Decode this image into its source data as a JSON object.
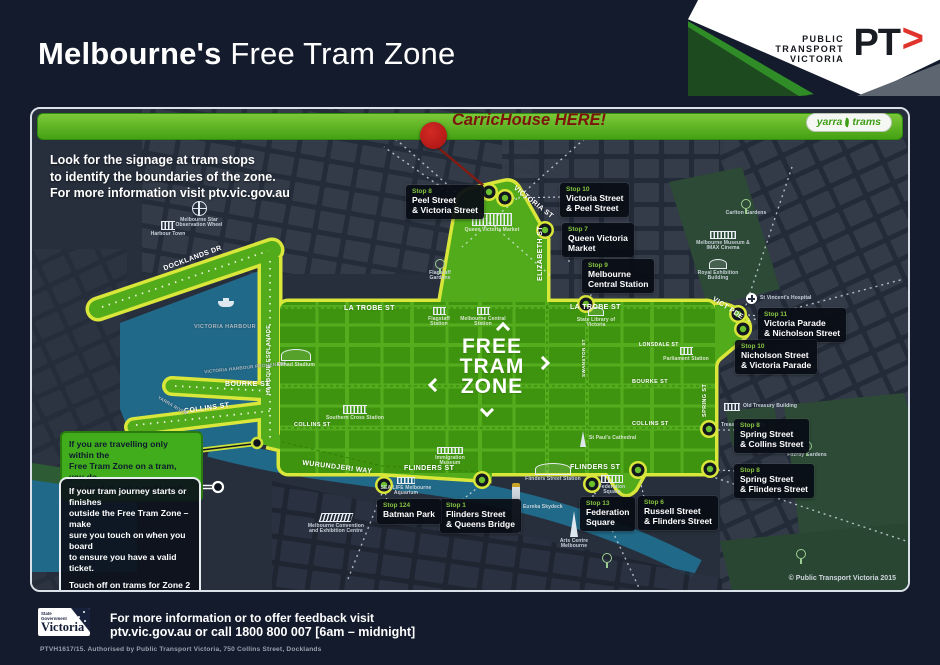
{
  "header": {
    "title_bold": "Melbourne's",
    "title_light": " Free Tram Zone",
    "ptv_lines": [
      "PUBLIC",
      "TRANSPORT",
      "VICTORIA"
    ],
    "ptv_logo": "PT",
    "ptv_chevron": ">"
  },
  "banner": {
    "marker_text": "CarricHouse HERE!",
    "yarra": "yarra",
    "trams": "trams"
  },
  "map": {
    "note_lines": [
      "Look for the signage at tram stops",
      "to identify the boundaries of the zone.",
      "For more information visit ptv.vic.gov.au"
    ],
    "zone_emblem": [
      "FREE",
      "TRAM",
      "ZONE"
    ],
    "copyright": "© Public Transport Victoria 2015",
    "streets": {
      "docklands": "DOCKLANDS DR",
      "latrobe": "LA TROBE ST",
      "victoria": "VICTORIA ST",
      "elizabeth": "ELIZABETH ST",
      "harbour_esp": "HARBOUR ESPLANADE",
      "bourke": "BOURKE ST",
      "collins": "COLLINS ST",
      "flinders": "FLINDERS ST",
      "wurundjeri": "WURUNDJERI WAY",
      "vict_pde": "VICT PDE",
      "spring": "SPRING ST",
      "lonsdale": "LONSDALE ST",
      "swanston": "SWANSTON ST",
      "vh_prom": "VICTORIA HARBOUR PROMENADE",
      "vic_harbour": "VICTORIA HARBOUR",
      "yarra_river": "YARRA RIVER"
    },
    "landmarks": {
      "harbour_town": "Harbour Town",
      "melb_star": "Melbourne Star Observation Wheel",
      "qvm": "Queen Victoria Market",
      "etihad": "Etihad Stadium",
      "southern_cross": "Southern Cross Station",
      "flagstaff_gardens": "Flagstaff Gardens",
      "flagstaff_station": "Flagstaff Station",
      "melb_central": "Melbourne Central Station",
      "state_library": "State Library of Victoria",
      "parliament": "Parliament Station",
      "carlton": "Carlton Gardens",
      "museum": "Melbourne Museum & IMAX Cinema",
      "exhibition": "Royal Exhibition Building",
      "st_vincents": "St Vincent's Hospital",
      "old_treasury": "Old Treasury Building",
      "treasury": "Treasury Gardens",
      "fitzroy": "Fitzroy Gardens",
      "st_pauls": "St Paul's Cathedral",
      "flinders_station": "Flinders Street Station",
      "fed_square": "Federation Square",
      "sealife": "SEA LIFE Melbourne Aquarium",
      "immigration": "Immigration Museum",
      "eureka": "Eureka Skydeck",
      "arts_centre": "Arts Centre Melbourne",
      "mcec": "Melbourne Convention and Exhibition Centre"
    },
    "stops": [
      {
        "n": "Stop 8",
        "l1": "Peel Street",
        "l2": "& Victoria Street"
      },
      {
        "n": "Stop 10",
        "l1": "Victoria Street",
        "l2": "& Peel Street"
      },
      {
        "n": "Stop 7",
        "l1": "Queen Victoria",
        "l2": "Market"
      },
      {
        "n": "Stop 9",
        "l1": "Melbourne",
        "l2": "Central Station"
      },
      {
        "n": "Stop 11",
        "l1": "Victoria Parade",
        "l2": "& Nicholson Street"
      },
      {
        "n": "Stop 10",
        "l1": "Nicholson Street",
        "l2": "& Victoria Parade"
      },
      {
        "n": "Stop 8",
        "l1": "Spring Street",
        "l2": "& Collins Street"
      },
      {
        "n": "Stop 8",
        "l1": "Spring Street",
        "l2": "& Flinders Street"
      },
      {
        "n": "Stop 6",
        "l1": "Russell Street",
        "l2": "& Flinders Street"
      },
      {
        "n": "Stop 13",
        "l1": "Federation",
        "l2": "Square"
      },
      {
        "n": "Stop 1",
        "l1": "Flinders Street",
        "l2": "& Queens Bridge"
      },
      {
        "n": "Stop 124",
        "l1": "Batman Park",
        "l2": ""
      }
    ],
    "info_green_lines": [
      "If you are travelling only within the",
      "Free Tram Zone on a tram, you do",
      "not need to use a myki card."
    ],
    "info_dark_p1": [
      "If your tram journey starts or finishes",
      "outside the Free Tram Zone – make",
      "sure you touch on when you board",
      "to ensure you have a valid ticket."
    ],
    "info_dark_p2": [
      "Touch off on trams for Zone 2",
      "only trips."
    ]
  },
  "footer": {
    "logo_small": "State Government",
    "logo_name": "Victoria",
    "line1": "For more information or to offer feedback visit",
    "line2": "ptv.vic.gov.au or call 1800 800 007 [6am – midnight]",
    "fine_print": "PTVH1617/15. Authorised by Public Transport Victoria, 750 Collins Street, Docklands"
  },
  "colors": {
    "zone_green": "#52ab1b",
    "zone_border": "#d9e63a",
    "banner_green": "#58b51f",
    "marker_red": "#c01a1b",
    "water_teal": "#206988",
    "ptv_red": "#e0332c"
  }
}
